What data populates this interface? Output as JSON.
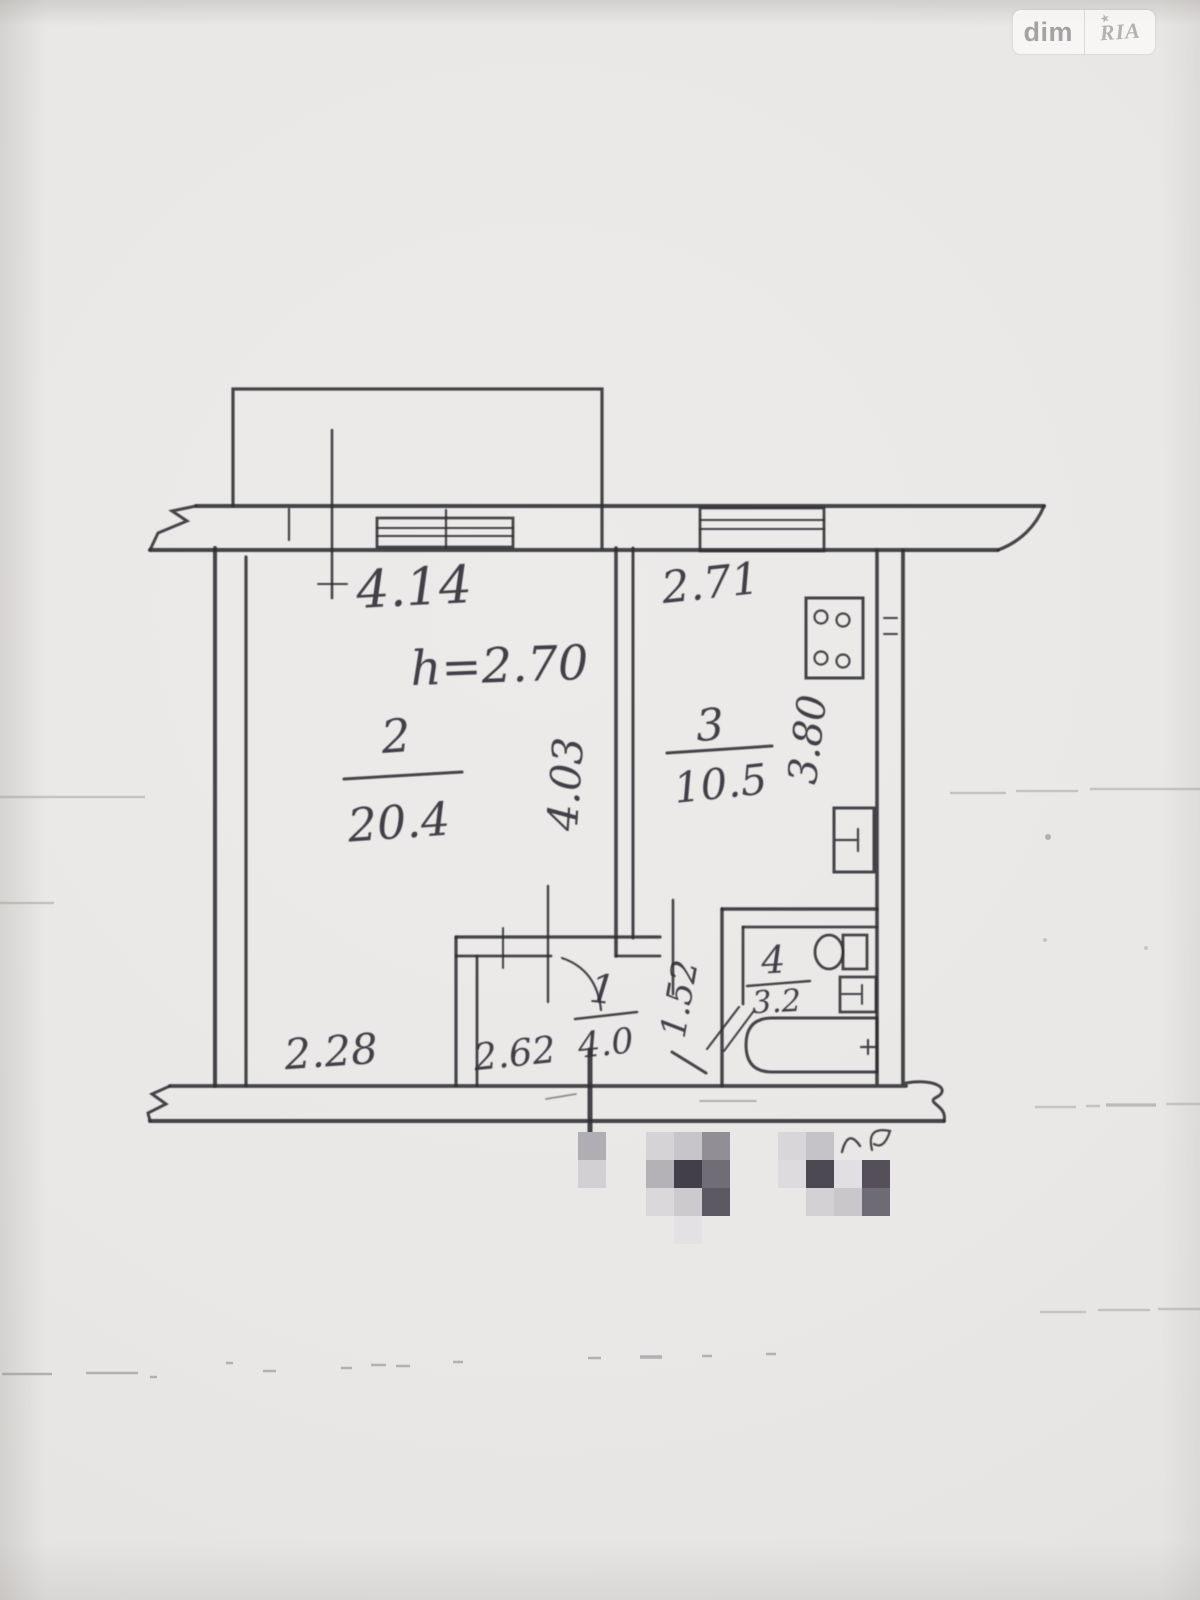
{
  "watermark": {
    "left": "dim",
    "right": "RIA",
    "star": "★"
  },
  "plan": {
    "height_note": "h=2.70",
    "dimensions": {
      "living_width": "4.14",
      "kitchen_width": "2.71",
      "living_depth": "4.03",
      "kitchen_depth": "3.80",
      "living_bottom": "2.28",
      "hall_width": "2.62",
      "hall_depth": "1.52"
    },
    "rooms": {
      "hall": {
        "number": "1",
        "area": "4.0"
      },
      "living": {
        "number": "2",
        "area": "20.4"
      },
      "kitchen": {
        "number": "3",
        "area": "10.5"
      },
      "bath": {
        "number": "4",
        "area": "3.2"
      }
    }
  },
  "redaction": {
    "cell_size": 28,
    "cells": [
      [
        578,
        1132,
        "#b0adb3"
      ],
      [
        578,
        1160,
        "#d3d0d4"
      ],
      [
        646,
        1132,
        "#d6d3d6"
      ],
      [
        674,
        1132,
        "#c8c5ca"
      ],
      [
        702,
        1132,
        "#918e96"
      ],
      [
        646,
        1160,
        "#b4b1b7"
      ],
      [
        674,
        1160,
        "#423f49"
      ],
      [
        702,
        1160,
        "#706d76"
      ],
      [
        646,
        1188,
        "#dad8da"
      ],
      [
        674,
        1188,
        "#cdcace"
      ],
      [
        702,
        1188,
        "#5c5963"
      ],
      [
        674,
        1216,
        "#e3e1e3"
      ],
      [
        778,
        1132,
        "#d8d6d9"
      ],
      [
        806,
        1132,
        "#c6c3c8"
      ],
      [
        778,
        1160,
        "#dddbdd"
      ],
      [
        806,
        1160,
        "#4c4952"
      ],
      [
        834,
        1160,
        "#e1dfe1"
      ],
      [
        862,
        1160,
        "#544f59"
      ],
      [
        806,
        1188,
        "#d4d1d5"
      ],
      [
        834,
        1188,
        "#cac7cb"
      ],
      [
        862,
        1188,
        "#6e6b74"
      ]
    ]
  }
}
